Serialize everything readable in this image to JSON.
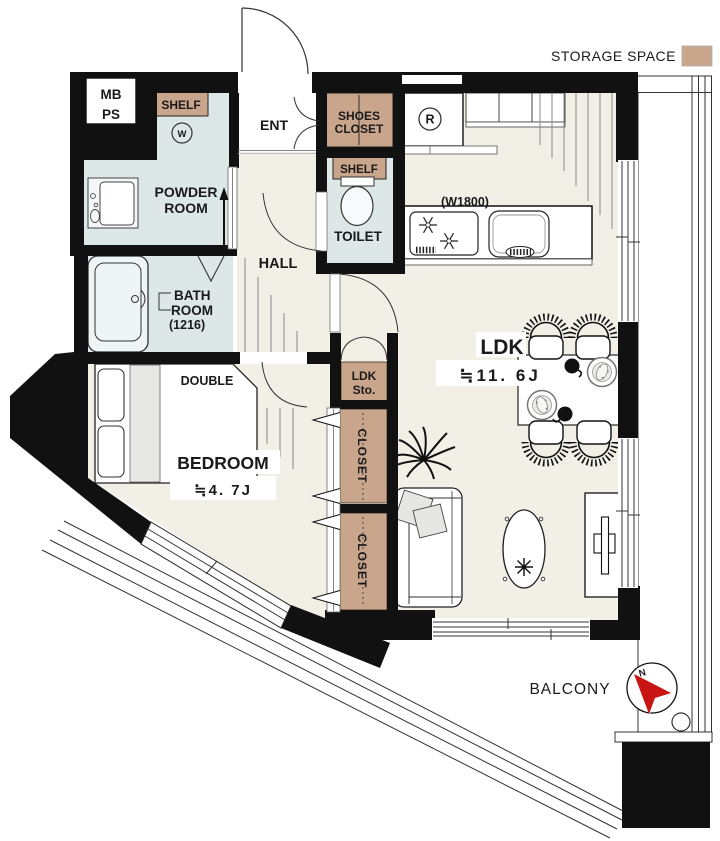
{
  "legend": {
    "storage_space_label": "STORAGE SPACE"
  },
  "colors": {
    "wall": "#111111",
    "floor": "#F1EFE6",
    "wet_room": "#DDE7E8",
    "storage": "#C9A58C",
    "compass_north": "#C91414"
  },
  "rooms": {
    "utility": {
      "mb": "MB",
      "ps": "PS",
      "shelf": "SHELF",
      "washer": "W"
    },
    "powder_room": {
      "line1": "POWDER",
      "line2": "ROOM"
    },
    "bath_room": {
      "line1": "BATH",
      "line2": "ROOM",
      "line3": "(1216)"
    },
    "ent": {
      "label": "ENT"
    },
    "shoes_closet": {
      "line1": "SHOES",
      "line2": "CLOSET"
    },
    "toilet": {
      "label": "TOILET",
      "shelf": "SHELF"
    },
    "hall": {
      "label": "HALL"
    },
    "ldk": {
      "label": "LDK",
      "size": "≒11. 6J",
      "kitchen_width": "(W1800)",
      "fridge_mark": "R"
    },
    "ldk_storage": {
      "line1": "LDK",
      "line2": "Sto."
    },
    "closet_upper": {
      "label": "CLOSET"
    },
    "closet_lower": {
      "label": "CLOSET"
    },
    "bedroom": {
      "label": "BEDROOM",
      "size": "≒4. 7J",
      "bed": "DOUBLE"
    },
    "balcony": {
      "label": "BALCONY"
    }
  },
  "compass": {
    "north_label": "N"
  }
}
